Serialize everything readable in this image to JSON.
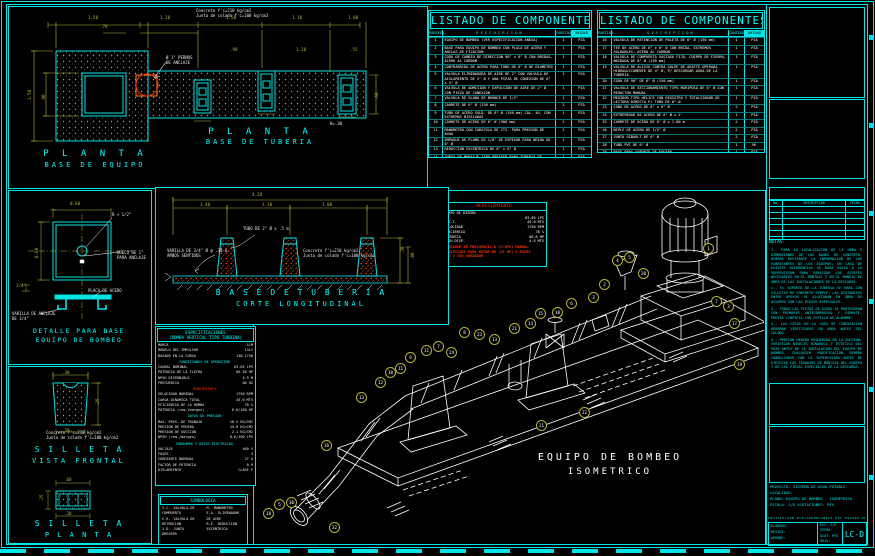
{
  "colors": {
    "line": "#00ffff",
    "dim": "#b3b33d",
    "alert": "#ff2a00",
    "orange": "#ff7f27",
    "concrete_dot": "#9a9a9a"
  },
  "plan": {
    "title_top": "P L A N T A",
    "subtitle_top": "BASE DE TUBERIA",
    "title_bottom": "P L A N T A",
    "subtitle_bottom": "BASE DE EQUIPO",
    "labels": [
      {
        "x": 196,
        "y": 9,
        "t": "Concreto f'c=210 kg/cm2"
      },
      {
        "x": 196,
        "y": 14,
        "t": "Junta de colado f'c=100 kg/cm2"
      },
      {
        "x": 166,
        "y": 56,
        "t": "Ø 1\" PERNOS"
      },
      {
        "x": 166,
        "y": 61,
        "t": "DE ANCLAJE"
      },
      {
        "x": 330,
        "y": 122,
        "t": "H=.30"
      }
    ],
    "dims": [
      {
        "x": 88,
        "y": 15,
        "t": "1.50"
      },
      {
        "x": 160,
        "y": 15,
        "t": "1.10"
      },
      {
        "x": 226,
        "y": 15,
        "t": "1.50"
      },
      {
        "x": 292,
        "y": 15,
        "t": "1.10"
      },
      {
        "x": 348,
        "y": 15,
        "t": "1.00"
      },
      {
        "x": 100,
        "y": 24,
        "t": ".70"
      },
      {
        "x": 230,
        "y": 47,
        "t": ".90"
      },
      {
        "x": 296,
        "y": 47,
        "t": "1.10"
      },
      {
        "x": 350,
        "y": 47,
        "t": ".55"
      },
      {
        "x": 27,
        "y": 100,
        "t": "1.50",
        "cls": "v"
      },
      {
        "x": 41,
        "y": 102,
        "t": ".90",
        "cls": "v"
      },
      {
        "x": 374,
        "y": 100,
        "t": ".60",
        "cls": "v"
      }
    ]
  },
  "corte": {
    "title": "B A S E   D E   T U B E R I A",
    "subtitle": "CORTE LONGITUDINAL",
    "labels": [
      {
        "x": 167,
        "y": 249,
        "t": "VARILLA DE 3/4\" Ø @ .30 m."
      },
      {
        "x": 167,
        "y": 254,
        "t": "AMBOS SENTIDOS"
      },
      {
        "x": 243,
        "y": 227,
        "t": "TUBO DE 2\" Ø x .5 m."
      },
      {
        "x": 303,
        "y": 249,
        "t": "Concreto f'c=210 kg/cm2"
      },
      {
        "x": 303,
        "y": 254,
        "t": "Junta de colado f'c=100 kg/cm2"
      }
    ],
    "dims": [
      {
        "x": 252,
        "y": 192,
        "t": "4.20"
      },
      {
        "x": 200,
        "y": 202,
        "t": "1.40"
      },
      {
        "x": 262,
        "y": 202,
        "t": "1.10"
      },
      {
        "x": 322,
        "y": 202,
        "t": "1.00"
      },
      {
        "x": 400,
        "y": 254,
        "t": ".70",
        "cls": "v"
      },
      {
        "x": 410,
        "y": 260,
        "t": ".80",
        "cls": "v"
      }
    ]
  },
  "detalle": {
    "title": "DETALLE PARA BASE",
    "subtitle": "EQUIPO DE BOMBEO",
    "labels": [
      {
        "x": 112,
        "y": 213,
        "t": "R + 1/2\""
      },
      {
        "x": 117,
        "y": 251,
        "t": "HUECO DE 1\""
      },
      {
        "x": 117,
        "y": 256,
        "t": "PARA ANCLAJE"
      },
      {
        "x": 88,
        "y": 289,
        "t": "PLACA DE ACERO"
      },
      {
        "x": 12,
        "y": 312,
        "t": "VARILLA DE ANCLAJE"
      },
      {
        "x": 12,
        "y": 317,
        "t": "DE 3/4\""
      }
    ],
    "dims": [
      {
        "x": 70,
        "y": 201,
        "t": "0.60"
      },
      {
        "x": 34,
        "y": 258,
        "t": "0.60",
        "cls": "v"
      },
      {
        "x": 16,
        "y": 283,
        "t": "3/4\""
      }
    ]
  },
  "silleta": {
    "title_front": "S I L L E T A",
    "subtitle_front": "VISTA FRONTAL",
    "title_plan": "S I L L E T A",
    "subtitle_plan": "P L A N T A",
    "labels": [
      {
        "x": 46,
        "y": 431,
        "t": "Concreto f'c=210 kg/cm2"
      },
      {
        "x": 46,
        "y": 436,
        "t": "Junta de colado f'c=100 kg/cm2"
      }
    ],
    "dims": [
      {
        "x": 62,
        "y": 370,
        "t": ".30"
      },
      {
        "x": 95,
        "y": 406,
        "t": ".25",
        "cls": "v"
      },
      {
        "x": 62,
        "y": 428,
        "t": ".30"
      },
      {
        "x": 64,
        "y": 477,
        "t": ".60"
      },
      {
        "x": 39,
        "y": 502,
        "t": ".25",
        "cls": "v"
      },
      {
        "x": 64,
        "y": 511,
        "t": ".20"
      }
    ]
  },
  "tables": [
    {
      "title": "LISTADO DE COMPONENTES",
      "cols": [
        "PARTIDA",
        "D E S C R I P C I O N",
        "CANTIDAD",
        "UNIDAD"
      ],
      "rows": [
        {
          "n": "1",
          "d": "EQUIPO DE BOMBEO (VER ESPECIFICACION ANEXA)",
          "c": "1",
          "u": "PZA"
        },
        {
          "n": "2",
          "d": "BASE PARA EQUIPO DE BOMBEO CON PLACA DE ACERO Y ANCLAS DE FIJACION",
          "c": "1",
          "u": "PZA"
        },
        {
          "n": "3",
          "d": "CODO DE CAMBIO DE DIRECCION 90° x 6\" Ø CON BRIDAS, ACERO AL CARBON",
          "c": "1",
          "u": "PZA"
        },
        {
          "n": "4",
          "d": "CONTRABRIDA DE ACERO PARA TUBO DE 6\" Ø DE DIAMETRO",
          "c": "1",
          "u": "PZA"
        },
        {
          "n": "5",
          "d": "VALVULA ELIMINADORA DE AIRE DE 2\" CON VALVULA DE AISLAMIENTO DE 2\" Ø Y UNA PIEZA DE CONEXION DE 6\" x 2\" Ø",
          "c": "1",
          "u": "PZA"
        },
        {
          "n": "6",
          "d": "VALVULA DE ADMISION Y EXPULSION DE AIRE DE 2\" Ø CON PIEZA DE CONEXION",
          "c": "1",
          "u": "PZA"
        },
        {
          "n": "7",
          "d": "VALVULA DE GLOBO DE BRONCE DE 1/2\"",
          "c": "1",
          "u": "PZA"
        },
        {
          "n": "8",
          "d": "CARRETE DE 6\" Ø (150 mm)",
          "c": "2",
          "u": "PZA"
        },
        {
          "n": "9",
          "d": "TUBO DE ACERO SOLD. DE 6\" Ø (150 mm) CAL. 40, CON EXTREMOS BISELADOS",
          "c": "1",
          "u": "PZA"
        },
        {
          "n": "10",
          "d": "CARRETE DE ACERO DE 6\" Ø (900 mm)",
          "c": "2",
          "u": "PZA"
        },
        {
          "n": "11",
          "d": "MANOMETRO CON CARATULA DE CTS. PARA PRESION DE AGUA",
          "c": "2",
          "u": "PZA"
        },
        {
          "n": "12",
          "d": "EMPAQUE DE PLOMO DE 1/8\" DE ESPESOR PARA BRIDA DE 6\" Ø",
          "c": "1",
          "u": "PZA"
        },
        {
          "n": "13",
          "d": "REDUCCION EXCENTRICA DE 8\" x 6\" Ø",
          "c": "1",
          "u": "PZA"
        },
        {
          "n": "14",
          "d": "JUNTA DE MONTAJE TIPO DRESSER PARA TUBERIA DE ACERO DE 6\" Ø CON TORNILLERIA GALVANIZADA",
          "c": "1",
          "u": "PZA"
        },
        {
          "n": "15",
          "d": "SILLETA DE CONCRETO PARA APOYO DE TUBERIA DE 6\" Ø (VER DETALLE)",
          "c": "3",
          "u": "PZA"
        }
      ]
    },
    {
      "title": "LISTADO DE COMPONENTES",
      "cols": [
        "PARTIDA",
        "D E S C R I P C I O N",
        "CANTIDAD",
        "UNIDAD"
      ],
      "rows": [
        {
          "n": "16",
          "d": "VALVULA DE RETENCION DE PALETA DE 6\" Ø (150 mm)",
          "c": "1",
          "u": "PZA"
        },
        {
          "n": "17",
          "d": "TEE DE ACERO DE 6\" x 6\" Ø CON BRIDA, EXTREMOS SOLDABLES, ACERO AL CARBON",
          "c": "1",
          "u": "PZA"
        },
        {
          "n": "18",
          "d": "VALVULA DE COMPUERTA VASTAGO FIJO, CUERPO DE FIERRO, BRIDADA DE 6\" Ø (150 mm)",
          "c": "1",
          "u": "PZA"
        },
        {
          "n": "19",
          "d": "VALVULA DE ALIVIO CONTRA GOLPE DE ARIETE OPERADA HIDRAULICAMENTE DE 4\" Ø, P/ DESCARGAR AGUA DE LA TUBERIA",
          "c": "1",
          "u": "PZA"
        },
        {
          "n": "20",
          "d": "CODO DE 90° DE 6\" Ø (150 mm)",
          "c": "1",
          "u": "PZA"
        },
        {
          "n": "21",
          "d": "VALVULA DE SECCIONAMIENTO TIPO MARIPOSA DE 6\" Ø CON REDUCTOR MANUAL",
          "c": "1",
          "u": "PZA"
        },
        {
          "n": "22",
          "d": "MEDIDOR TIPO HELICE CON REGISTRO Y TOTALIZADOR DE LECTURA DIRECTA P/ TUBO DE 6\" Ø",
          "c": "1",
          "u": "PZA"
        },
        {
          "n": "23",
          "d": "CONO DE ACERO DE 8\" x 6\" Ø",
          "c": "2",
          "u": "PZA"
        },
        {
          "n": "24",
          "d": "EXTREMIDAD DE ACERO DE 6\" Ø x 2'",
          "c": "1",
          "u": "PZA"
        },
        {
          "n": "25",
          "d": "CARRETE DE ACERO DE 6\" Ø x 1.00 m",
          "c": "2",
          "u": "PZA"
        },
        {
          "n": "26",
          "d": "NIPLE DE ACERO DE 1/2\" Ø",
          "c": "2",
          "u": "PZA"
        },
        {
          "n": "27",
          "d": "JUNTA GIBAULT DE 6\" Ø",
          "c": "2",
          "u": "PZA"
        },
        {
          "n": "28",
          "d": "TUBO PVC DE 6\" Ø",
          "c": "1",
          "u": "ML"
        },
        {
          "n": "29",
          "d": "BASE PARA SOPORTE DE EQUIPO",
          "c": "1",
          "u": "PZA"
        },
        {
          "n": "30",
          "d": "ANCLAJE PARA SOPORTE DE TUBERIA",
          "c": "2",
          "u": "PZA"
        },
        {
          "n": "31",
          "d": "LOSA PARA APOYO DE SILLETAS DE TUBERIA",
          "c": "1",
          "u": "PZA"
        }
      ]
    }
  ],
  "spec": {
    "title1": "ESPECIFICACIONES",
    "title2": "(BOMBA VERTICAL TIPO TURBINA)",
    "items": [
      {
        "l": "MARCA",
        "v": "S/M"
      },
      {
        "l": "MODELO DEL IMPULSOR",
        "v": "13LC"
      },
      {
        "l": "BASADO EN LA CURVA",
        "v": "13B-1750"
      },
      {
        "l": "CONDICIONES DE OPERACION",
        "cls": "hdr"
      },
      {
        "l": "CAUDAL NOMINAL",
        "v": "63.65 LPS"
      },
      {
        "l": "POTENCIA DE LA FLECHA",
        "v": "66.56 HP"
      },
      {
        "l": "NPSH DISPONIBLE",
        "v": "4.5 M"
      },
      {
        "l": "FRECUENCIA",
        "v": "60 HZ"
      },
      {
        "l": "RENDIMIENTO",
        "cls": "hdr red"
      },
      {
        "l": "VELOCIDAD NOMINAL",
        "v": "1750 RPM"
      },
      {
        "l": "CARGA DINAMICA TOTAL",
        "v": "45.0 MTS"
      },
      {
        "l": "EFICIENCIA DE LA BOMBA",
        "v": "78 %"
      },
      {
        "l": "POTENCIA (req./margen)",
        "v": "8.6/100 HP"
      },
      {
        "l": "DATOS DE PRESION",
        "cls": "hdr"
      },
      {
        "l": "MAX. PRES. DE TRABAJO",
        "v": "10.5 KG/CM2"
      },
      {
        "l": "PRESION DE PRUEBA",
        "v": "15.8 KG/CM2"
      },
      {
        "l": "PRESION DE SUCCION",
        "v": "2.1 KG/CM2"
      },
      {
        "l": "NPSH (req./margen)",
        "v": "8.6/100 LPS"
      },
      {
        "l": "CONSUMOS Y DATOS ELECTRICOS",
        "cls": "hdr"
      },
      {
        "l": "VOLTAJE",
        "v": "460 V"
      },
      {
        "l": "FASES",
        "v": "3"
      },
      {
        "l": "CORRIENTE NOMINAL",
        "v": "27 A"
      },
      {
        "l": "FACTOR DE POTENCIA",
        "v": "0.9"
      },
      {
        "l": "AISLAMIENTO",
        "v": "CLASE F"
      }
    ]
  },
  "legend": {
    "title": "SIMBOLOGIA",
    "items": [
      {
        "l": "V.C.",
        "v": "VALVULA DE COMPUERTA"
      },
      {
        "l": "V.R.",
        "v": "VALVULA DE RETENCION"
      },
      {
        "l": "J.D.",
        "v": "JUNTA DRESSER"
      },
      {
        "l": "M.",
        "v": "MANOMETRO"
      },
      {
        "l": "E.A.",
        "v": "ELIMINADOR DE AIRE"
      },
      {
        "l": "R.E.",
        "v": "REDUCCION EXCENTRICA"
      }
    ]
  },
  "revest": {
    "title": "REVESTIMIENTO",
    "rows": [
      {
        "l": "PUNTO DE DISEÑO",
        "v": ""
      },
      {
        "l": "Q",
        "v": "63.65 LPS"
      },
      {
        "l": "C.D.T.",
        "v": "45.0 MTS"
      },
      {
        "l": "VELOCIDAD",
        "v": "1750 RPM"
      },
      {
        "l": "EFICIENCIA",
        "v": "78 %"
      },
      {
        "l": "POTENCIA",
        "v": "86.6 HP"
      },
      {
        "l": "NPSH DISP.",
        "v": "4.5 MTS"
      }
    ],
    "warn": [
      "VARIADOR DE FRECUENCIA A (V/OPS) MANUAL",
      "MODIFICADO PARA MOTOR DE (25 HP) 3 FASES",
      "460 V CON VARIADOR"
    ]
  },
  "iso": {
    "title": "EQUIPO DE BOMBEO",
    "subtitle": "ISOMETRICO",
    "balloons": [
      {
        "x": 703,
        "y": 243,
        "t": "1"
      },
      {
        "x": 638,
        "y": 268,
        "t": "20"
      },
      {
        "x": 612,
        "y": 255,
        "t": "4"
      },
      {
        "x": 624,
        "y": 252,
        "t": "5"
      },
      {
        "x": 599,
        "y": 279,
        "t": "2"
      },
      {
        "x": 588,
        "y": 292,
        "t": "3"
      },
      {
        "x": 566,
        "y": 298,
        "t": "6"
      },
      {
        "x": 552,
        "y": 307,
        "t": "10"
      },
      {
        "x": 535,
        "y": 308,
        "t": "15"
      },
      {
        "x": 525,
        "y": 318,
        "t": "14"
      },
      {
        "x": 509,
        "y": 323,
        "t": "21"
      },
      {
        "x": 489,
        "y": 334,
        "t": "13"
      },
      {
        "x": 474,
        "y": 329,
        "t": "23"
      },
      {
        "x": 459,
        "y": 327,
        "t": "8"
      },
      {
        "x": 446,
        "y": 347,
        "t": "24"
      },
      {
        "x": 433,
        "y": 341,
        "t": "7"
      },
      {
        "x": 421,
        "y": 345,
        "t": "11"
      },
      {
        "x": 405,
        "y": 352,
        "t": "9"
      },
      {
        "x": 395,
        "y": 363,
        "t": "11"
      },
      {
        "x": 385,
        "y": 367,
        "t": "10"
      },
      {
        "x": 375,
        "y": 377,
        "t": "12"
      },
      {
        "x": 356,
        "y": 392,
        "t": "13"
      },
      {
        "x": 321,
        "y": 440,
        "t": "16"
      },
      {
        "x": 286,
        "y": 497,
        "t": "30"
      },
      {
        "x": 274,
        "y": 499,
        "t": "5"
      },
      {
        "x": 263,
        "y": 508,
        "t": "18"
      },
      {
        "x": 329,
        "y": 522,
        "t": "32"
      },
      {
        "x": 711,
        "y": 296,
        "t": "7"
      },
      {
        "x": 723,
        "y": 301,
        "t": "3"
      },
      {
        "x": 729,
        "y": 318,
        "t": "17"
      },
      {
        "x": 734,
        "y": 359,
        "t": "19"
      },
      {
        "x": 579,
        "y": 407,
        "t": "22"
      },
      {
        "x": 536,
        "y": 420,
        "t": "21"
      }
    ]
  },
  "sidebar": {
    "notas_label": "NOTAS:",
    "rev_headers": {
      "a": "No.",
      "b": "DESCRIPCION",
      "c": "FECHA"
    },
    "rev_rows": [
      {},
      {},
      {},
      {},
      {},
      {}
    ],
    "notas": [
      "1.- PARA LA LOCALIZACION DE LA OBRA Y DIMENSIONES DE LAS BASES DE CONCRETO, DEBERA REVISARSE LA INFORMACION DE LOS FABRICANTES DE LOS EQUIPOS; EN CASO DE EXISTIR DIFERENCIAS SE DARA AVISO A LA SUPERVISION PARA REALIZAR LOS AJUSTES NECESARIOS EN EL MONTAJE Y EN EL MANEJO DE OBRA DE LAS INSTALACIONES DE LA DESCARGA.",
      "2.- EL SOPORTE DE LA TUBERIA SE HARA CON SILLETAS DE CONCRETO SIMPLE; LAS DISTANCIAS ENTRE APOYOS SE AJUSTARAN EN OBRA DE ACUERDO CON LAS PIEZAS ESPECIALES.",
      "3.- TODAS LAS PIEZAS DE ACERO SE PROTEGERAN CON PRIMARIO ANTICORROSIVO Y ESMALTE, PREVIA LIMPIEZA CON CEPILLO DE ALAMBRE.",
      "4.- LAS COTAS DE LA LOSA DE CIMENTACION DEBERAN VERIFICARSE EN OBRA ANTES DEL COLADO.",
      "5.- PRESION MINIMA REQUERIDA EN LA SUCCION; VERIFICAR NIVELES DINAMICO Y ESTATICO DEL POZO ANTES DE LA INSTALACION DEL EQUIPO DE BOMBEO. CUALQUIER MODIFICACION DEBERA CONSULTARSE CON LA SUPERVISION ANTES DE EJECUTAR LOS TRABAJOS DE MONTAJE DEL EQUIPO Y DE LAS PIEZAS ESPECIALES DE LA DESCARGA."
    ],
    "info_lines": [
      "PROYECTO: SISTEMA DE AGUA POTABLE",
      "LOCALIDAD:",
      "PLANO: EQUIPO DE BOMBEO - ISOMETRICO",
      "ESCALA: S/E      ACOTACIONES: MTS"
    ],
    "strip": "INSTALACION ELECTROMECANICA DEL EQUIPO DE BOMBEO",
    "tb_left": [
      "ELABORO:",
      "REVISO:",
      "APROBO:"
    ],
    "tb_mid": [
      "ESC: S/E",
      "FECHA:",
      "ACOT: MTS",
      "HOJA:"
    ],
    "code": "LC-D"
  }
}
